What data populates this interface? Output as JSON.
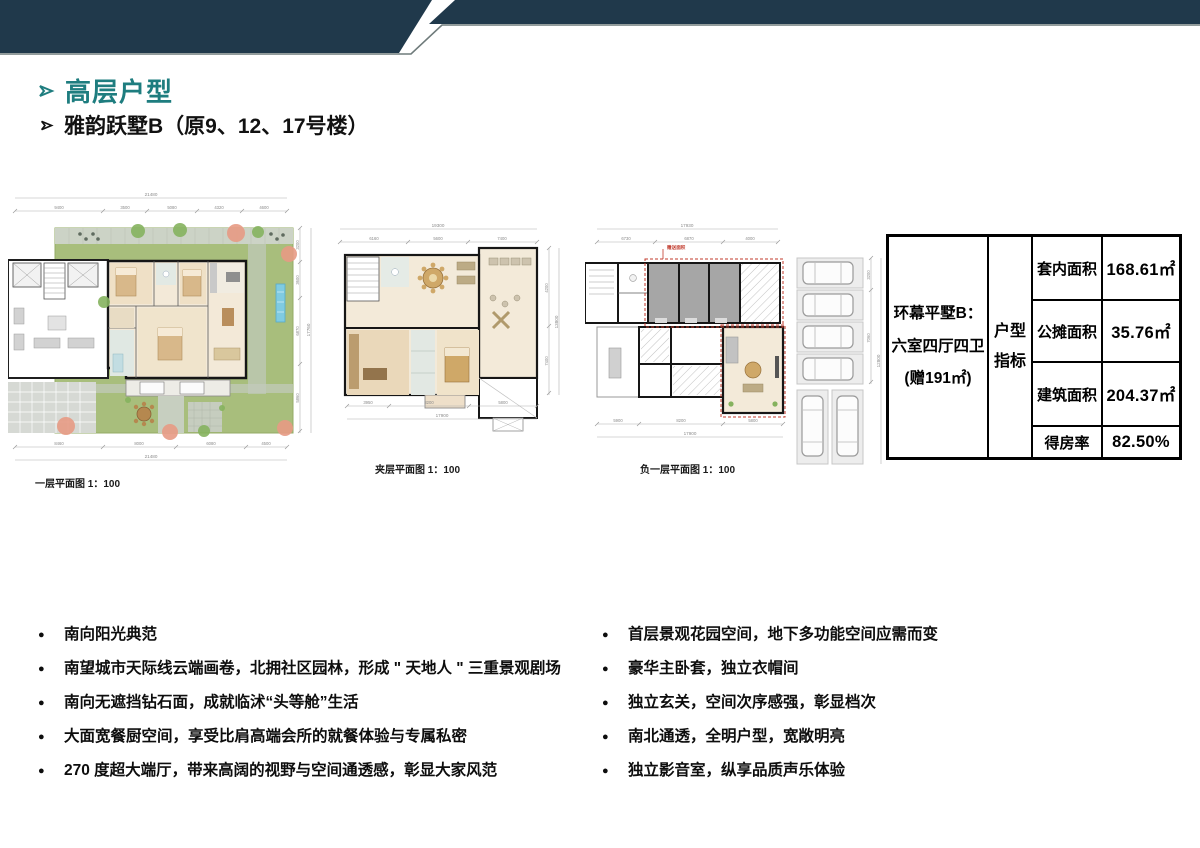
{
  "colors": {
    "header_dark": "#20394b",
    "header_line": "#6f7b7b",
    "title_teal": "#1e7d7f",
    "red_annotation": "#c0392b",
    "garden_green": "#a8be7c"
  },
  "titles": {
    "section": "高层户型",
    "sub": "雅韵跃墅B（原9、12、17号楼）"
  },
  "plans": [
    {
      "caption": "一层平面图 1：100",
      "top_total": "21480",
      "top": [
        "9400",
        "3500",
        "5080",
        "4320",
        "4600"
      ],
      "bottom": [
        "8460",
        "8000",
        "6080",
        "4500"
      ],
      "bottom_total": "21480",
      "right": [
        "3200",
        "3600",
        "6870",
        "5860"
      ],
      "right_total": "17760"
    },
    {
      "caption": "夹层平面图 1：100",
      "top_total": "19300",
      "top": [
        "6160",
        "5600",
        "7400"
      ],
      "bottom": [
        "3950",
        "8200",
        "5800"
      ],
      "bottom_total": "17900",
      "right": [
        "4200",
        "7400"
      ],
      "right_total": "13800"
    },
    {
      "caption": "负一层平面图 1：100",
      "top_total": "17930",
      "top": [
        "6730",
        "6870",
        "4000"
      ],
      "bottom": [
        "5900",
        "8200",
        "5800"
      ],
      "bottom_total": "17900",
      "right": [
        "3200",
        "7060"
      ],
      "right_total": "12800",
      "red_label": "赠送面积"
    }
  ],
  "spec_table": {
    "name_line1": "环幕平墅B：",
    "name_line2": "六室四厅四卫",
    "name_line3": "(赠191㎡)",
    "index_line1": "户型",
    "index_line2": "指标",
    "rows": [
      {
        "label": "套内面积",
        "value": "168.61㎡"
      },
      {
        "label": "公摊面积",
        "value": "35.76㎡"
      },
      {
        "label": "建筑面积",
        "value": "204.37㎡"
      },
      {
        "label": "得房率",
        "value": "82.50%"
      }
    ]
  },
  "bullets_left": [
    "南向阳光典范",
    "南望城市天际线云端画卷，北拥社区园林，形成 \" 天地人 \" 三重景观剧场",
    "南向无遮挡钻石面，成就临沭“头等舱”生活",
    "大面宽餐厨空间，享受比肩高端会所的就餐体验与专属私密",
    "270 度超大端厅，带来高阔的视野与空间通透感，彰显大家风范"
  ],
  "bullets_right": [
    "首层景观花园空间，地下多功能空间应需而变",
    "豪华主卧套，独立衣帽间",
    "独立玄关，空间次序感强，彰显档次",
    "南北通透，全明户型，宽敞明亮",
    "独立影音室，纵享品质声乐体验"
  ]
}
